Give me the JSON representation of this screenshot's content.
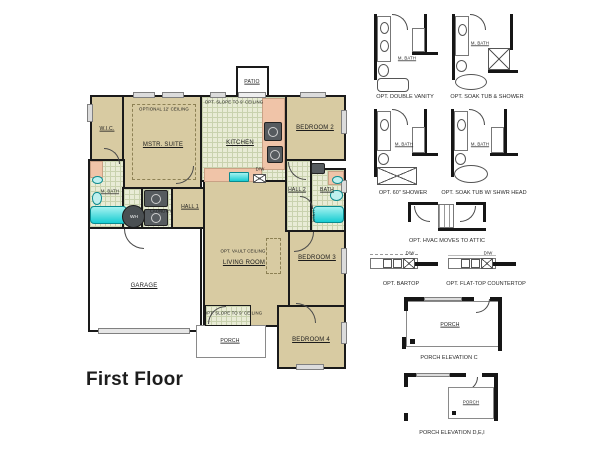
{
  "title": "First Floor",
  "plan": {
    "rooms": {
      "wic": "W.I.C.",
      "mstr_suite": "MSTR. SUITE",
      "kitchen": "KITCHEN",
      "bedroom2": "BEDROOM 2",
      "m_bath": "M. BATH",
      "laundry": "LAUNDRY",
      "hall1": "HALL 1",
      "hall2": "HALL 2",
      "bath": "BATH",
      "linen": "LINEN",
      "living_room": "LIVING ROOM",
      "bedroom3": "BEDROOM 3",
      "bedroom4": "BEDROOM 4",
      "garage": "GARAGE",
      "porch": "PORCH",
      "patio": "PATIO",
      "water_heater": "WH",
      "dishwasher": "D/W"
    },
    "notes": {
      "optional_ceiling": "OPTIONAL 12' CEILING",
      "slope_ceiling": "OPT. SLOPE TO 9' CEILING",
      "vault_ceiling": "OPT. VAULT CEILING"
    }
  },
  "options": [
    {
      "label": "OPT. DOUBLE VANITY",
      "inner": "M. BATH"
    },
    {
      "label": "OPT. SOAK TUB & SHOWER",
      "inner": "M. BATH"
    },
    {
      "label": "OPT. 60\" SHOWER",
      "inner": "M. BATH"
    },
    {
      "label": "OPT. SOAK TUB W/ SHWR HEAD",
      "inner": "M. BATH"
    },
    {
      "label": "OPT. HVAC MOVES TO ATTIC",
      "inner": ""
    },
    {
      "label": "OPT. BARTOP",
      "inner": "D/W"
    },
    {
      "label": "OPT. FLAT-TOP COUNTERTOP",
      "inner": "D/W"
    },
    {
      "label": "PORCH ELEVATION C",
      "inner": "PORCH"
    },
    {
      "label": "PORCH ELEVATION D,E,I",
      "inner": "PORCH"
    }
  ],
  "colors": {
    "room_tan": "#d8cba2",
    "tile_floor": "#e9ecd6",
    "fixture_cyan": "#25d8dc",
    "counter_salmon": "#f0c4a8",
    "wall": "#161616"
  }
}
